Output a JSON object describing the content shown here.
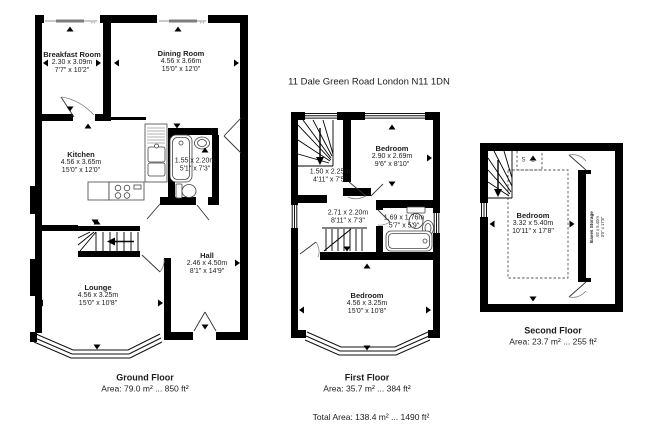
{
  "title": "11 Dale Green Road London N11 1DN",
  "total_area": "Total Area: 138.4 m² ... 1490 ft²",
  "glyphs": {
    "window_arrow": "↔"
  },
  "colors": {
    "wall": "#000000",
    "window_slider": "#888888",
    "text": "#1d1d1d"
  },
  "floors": {
    "ground": {
      "label": "Ground Floor",
      "area": "Area: 79.0 m² ... 850 ft²",
      "rooms": {
        "breakfast": {
          "name": "Breakfast Room",
          "metric": "2.30 x 3.09m",
          "imperial": "7'7\" x 10'2\""
        },
        "dining": {
          "name": "Dining Room",
          "metric": "4.56 x 3.66m",
          "imperial": "15'0\" x 12'0\""
        },
        "kitchen": {
          "name": "Kitchen",
          "metric": "4.56 x 3.65m",
          "imperial": "15'0\" x 12'0\""
        },
        "bathroom": {
          "metric": "1.55 x 2.20m",
          "imperial": "5'1\" x 7'3\""
        },
        "lounge": {
          "name": "Lounge",
          "metric": "4.56 x 3.25m",
          "imperial": "15'0\" x 10'8\""
        },
        "hall": {
          "name": "Hall",
          "metric": "2.46 x 4.50m",
          "imperial": "8'1\" x 14'9\""
        }
      }
    },
    "first": {
      "label": "First Floor",
      "area": "Area: 35.7 m² ... 384 ft²",
      "rooms": {
        "landing": {
          "metric": "1.50 x 2.25m",
          "imperial": "4'11\" x 7'5\""
        },
        "bedroom_rear": {
          "name": "Bedroom",
          "metric": "2.90 x 2.69m",
          "imperial": "9'6\" x 8'10\""
        },
        "inner": {
          "metric": "2.71 x 2.20m",
          "imperial": "8'11\" x 7'3\""
        },
        "bathroom": {
          "metric": "1.69 x 1.76m",
          "imperial": "5'7\" x 5'9\""
        },
        "bedroom_front": {
          "name": "Bedroom",
          "metric": "4.56 x 3.25m",
          "imperial": "15'0\" x 10'8\""
        }
      }
    },
    "second": {
      "label": "Second Floor",
      "area": "Area: 23.7 m² ... 255 ft²",
      "rooms": {
        "bedroom": {
          "name": "Bedroom",
          "metric": "3.32 x 5.40m",
          "imperial": "10'11\" x 17'8\""
        },
        "eaves": {
          "name": "Eaves Storage",
          "metric": ".92 x 5.40m",
          "imperial": "3'0\" x 17'8\""
        },
        "skylight": {
          "name": "S L"
        }
      }
    }
  }
}
